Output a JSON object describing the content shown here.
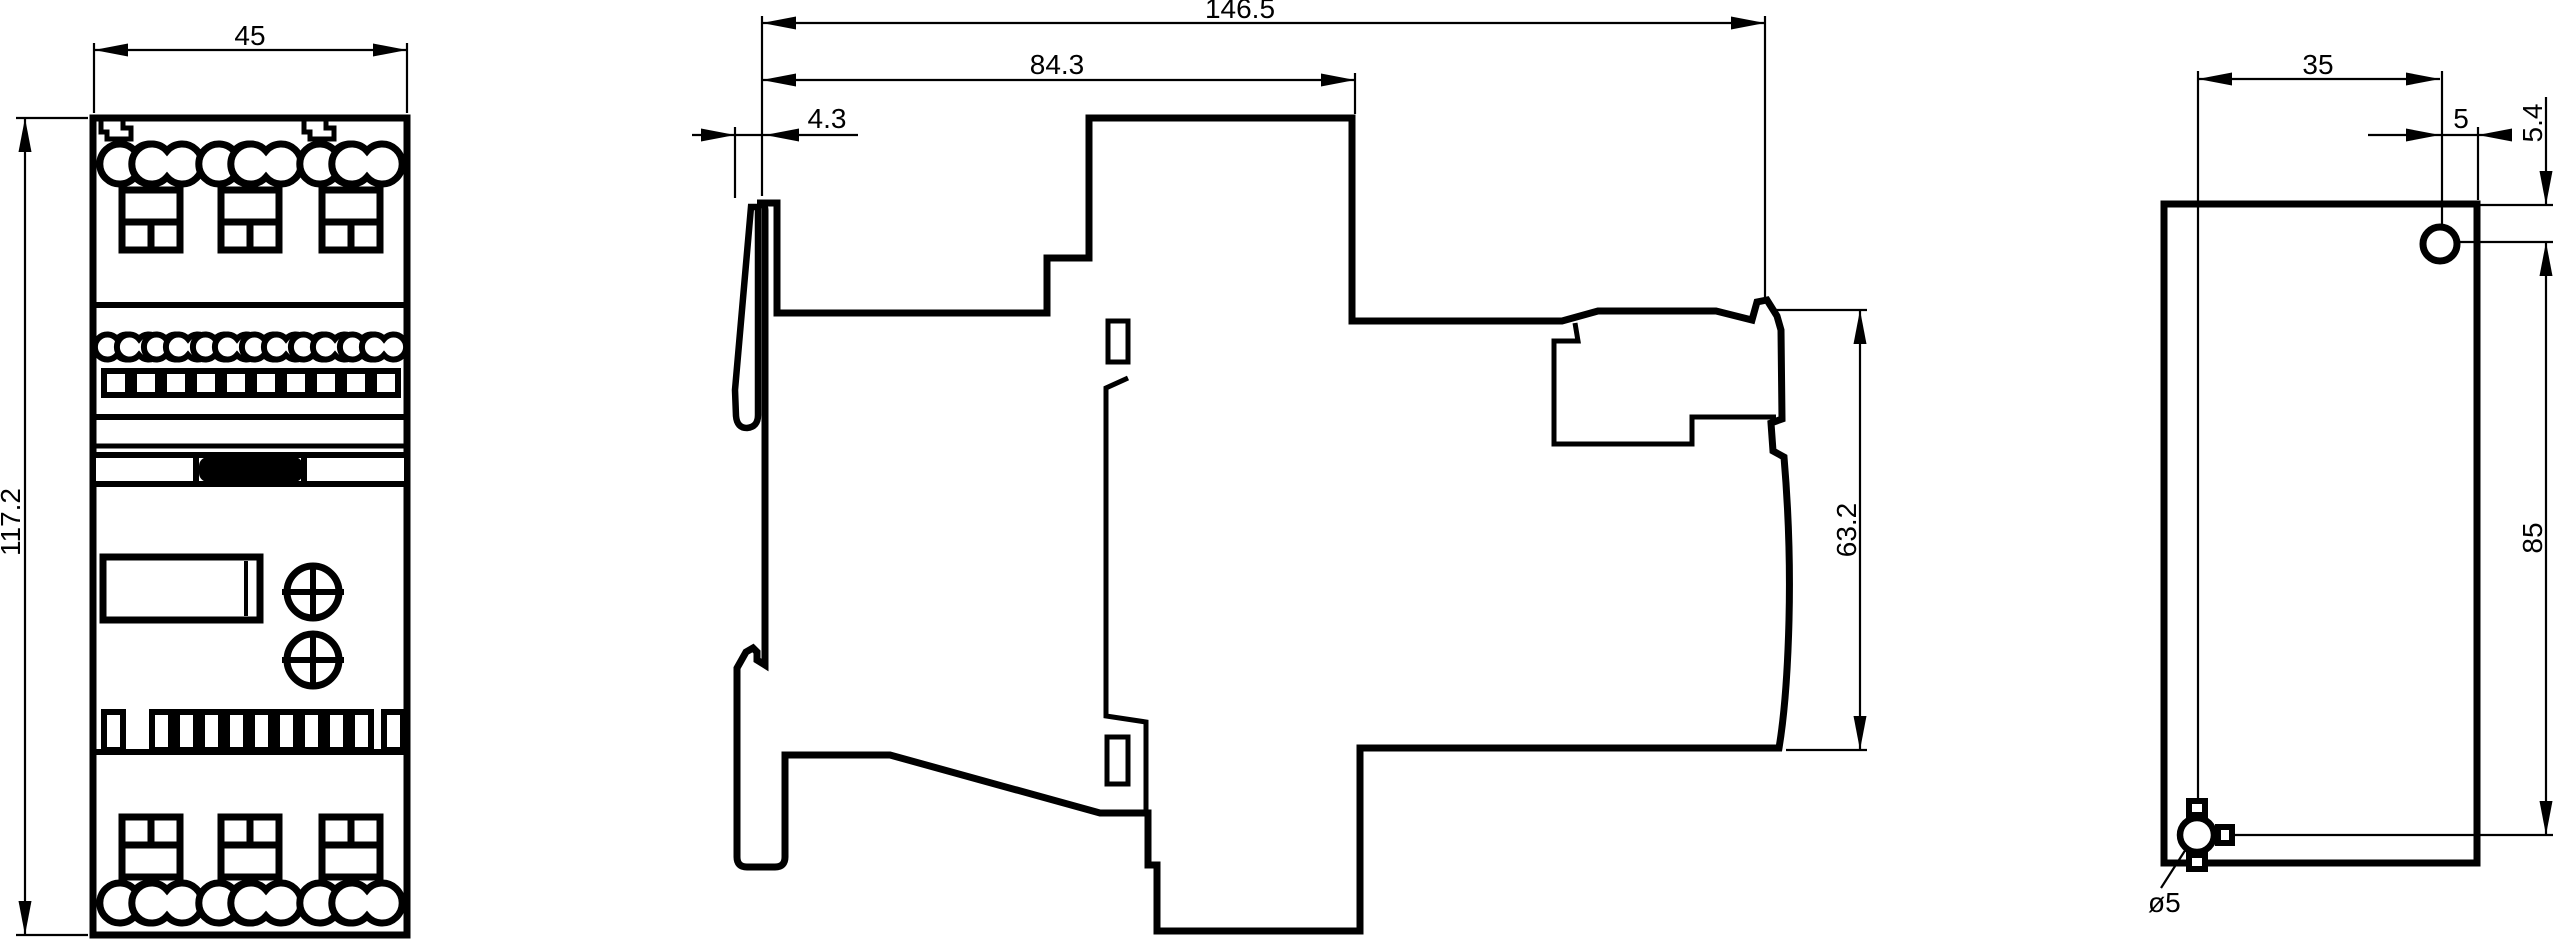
{
  "drawing": {
    "description": "Dimensional drawing of a DIN-rail mounted device with front, side and rear mounting views",
    "colors": {
      "line": "#000000",
      "background": "#ffffff"
    },
    "views": {
      "front": {
        "label": "front-view",
        "width": "45",
        "height": "117.2"
      },
      "side": {
        "label": "side-view",
        "overall_depth": "146.5",
        "body_depth": "84.3",
        "front_flange_depth": "4.3",
        "mounting_section_height": "63.2"
      },
      "rear": {
        "label": "rear-mounting-view",
        "hole_horizontal_spacing": "35",
        "hole_to_right_edge": "5",
        "hole_to_top_edge": "5.4",
        "hole_vertical_spacing": "85",
        "hole_diameter": "ø5"
      }
    }
  }
}
